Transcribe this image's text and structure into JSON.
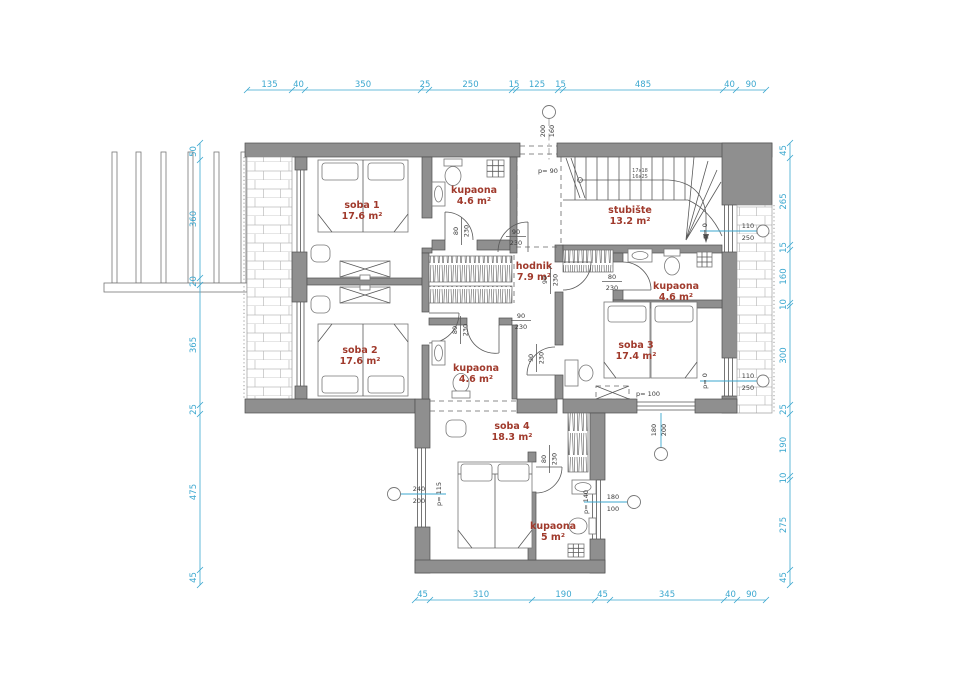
{
  "title": "floor plan - first floor",
  "colors": {
    "wall": "#8f8f8f",
    "dim": "#3BA7CF",
    "room": "#A03A2C",
    "ink": "#3a3a3a"
  },
  "rooms": [
    {
      "name": "soba 1",
      "area": "17.6 m²"
    },
    {
      "name": "kupaona",
      "area": "4.6 m²"
    },
    {
      "name": "stubište",
      "area": "13.2 m²"
    },
    {
      "name": "hodnik",
      "area": "7.9 m²"
    },
    {
      "name": "kupaona",
      "area": "4.6 m²"
    },
    {
      "name": "soba 2",
      "area": "17.6 m²"
    },
    {
      "name": "kupaona",
      "area": "4.6 m²"
    },
    {
      "name": "soba 3",
      "area": "17.4 m²"
    },
    {
      "name": "soba 4",
      "area": "18.3 m²"
    },
    {
      "name": "kupaona",
      "area": "5 m²"
    }
  ],
  "dims": {
    "top": [
      "135",
      "40",
      "350",
      "25",
      "250",
      "15",
      "125",
      "15",
      "485",
      "40",
      "90"
    ],
    "bottom": [
      "45",
      "310",
      "190",
      "45",
      "345",
      "40",
      "90"
    ],
    "left": [
      "50",
      "360",
      "20",
      "365",
      "25",
      "475",
      "45"
    ],
    "right": [
      "45",
      "265",
      "15",
      "160",
      "10",
      "300",
      "25",
      "190",
      "10",
      "275",
      "45"
    ]
  },
  "doors": [
    {
      "w": "80",
      "h": "230"
    },
    {
      "w": "90",
      "h": "230"
    },
    {
      "w": "90",
      "h": "230"
    },
    {
      "w": "80",
      "h": "230"
    },
    {
      "w": "90",
      "h": "230"
    },
    {
      "w": "80",
      "h": "230"
    },
    {
      "w": "80",
      "h": "230"
    },
    {
      "w": "90",
      "h": "230"
    }
  ],
  "windows": [
    {
      "w": "200",
      "h": "160",
      "p": "p= 90"
    },
    {
      "w": "110",
      "h": "250",
      "p": "p= 0"
    },
    {
      "w": "110",
      "h": "250",
      "p": "p= 0"
    },
    {
      "w": "180",
      "h": "200",
      "p": "p= 100"
    },
    {
      "w": "240",
      "h": "200",
      "p": "p= 115"
    },
    {
      "w": "180",
      "h": "100",
      "p": "p= 140"
    }
  ],
  "stairs": {
    "label1": "17x18",
    "label2": "16x25"
  }
}
